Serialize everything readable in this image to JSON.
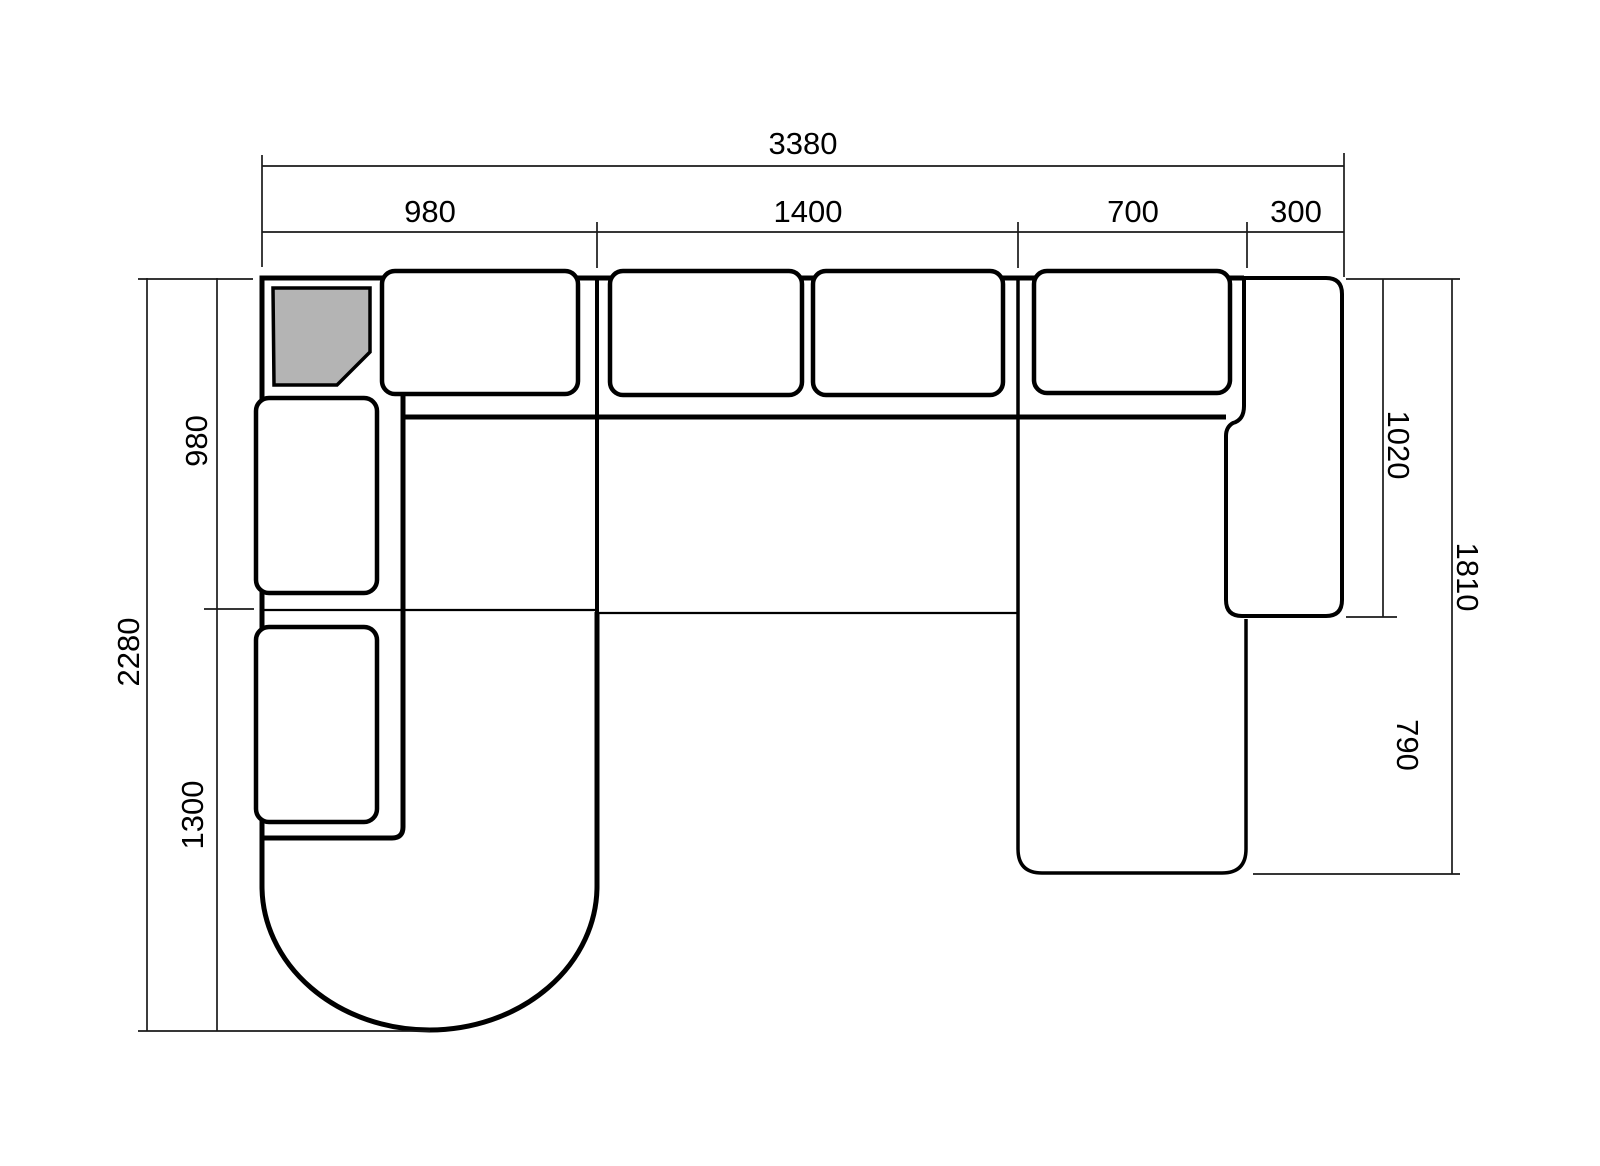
{
  "diagram": {
    "type": "sofa-floorplan-dimension-drawing",
    "dims": {
      "top_total": "3380",
      "top_segments": [
        "980",
        "1400",
        "700",
        "300"
      ],
      "left_total": "2280",
      "left_segments": [
        "980",
        "1300"
      ],
      "right_upper": "1020",
      "right_total": "1810",
      "right_lower": "790"
    },
    "colors": {
      "line": "#000000",
      "background": "#ffffff",
      "cushion_fill": "#ffffff",
      "corner_table_fill": "#b4b4b4"
    }
  }
}
